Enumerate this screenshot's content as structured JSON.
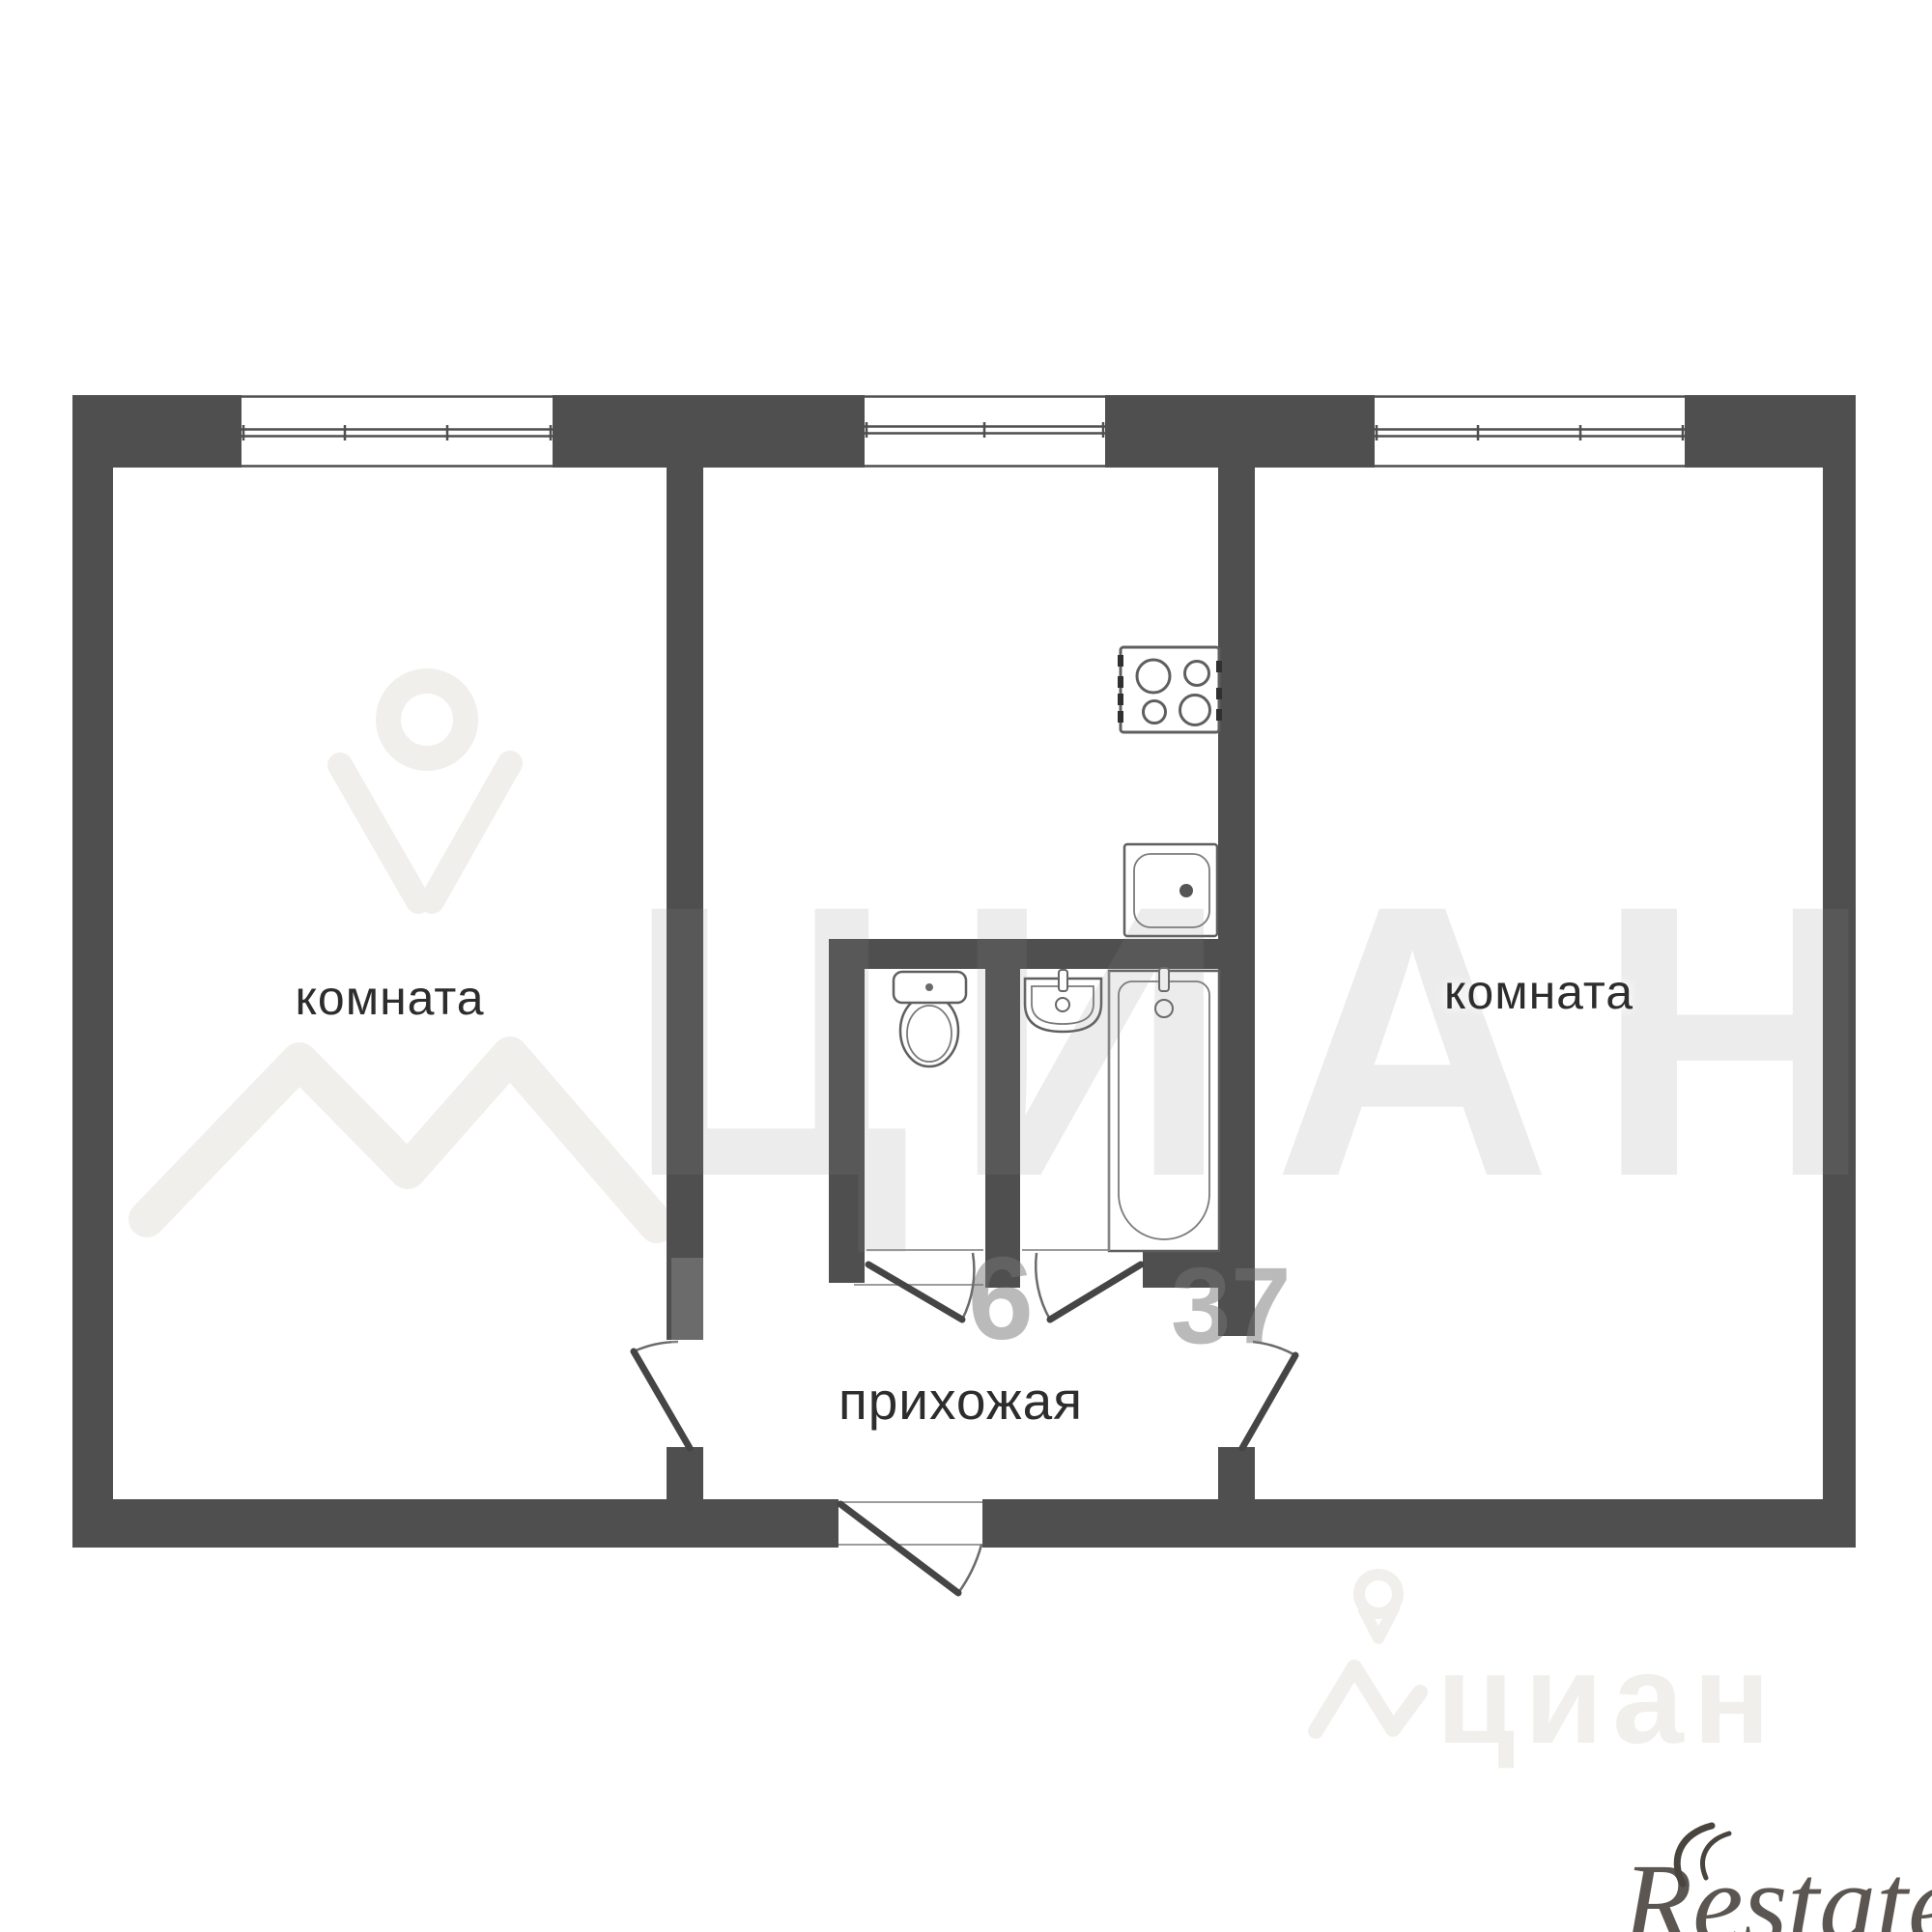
{
  "colors": {
    "background": "#ffffff",
    "wall": "#4f4f4f",
    "fixture_line": "#5f5f5f",
    "door_line": "#454545",
    "thin_line": "#9c9c9c",
    "label_text": "#2d2d2d",
    "watermark_gray": "#878787",
    "watermark_light": "#f1efec",
    "restate_color": "#4a443f"
  },
  "labels": {
    "room_left": "комната",
    "room_right": "комната",
    "hallway": "прихожая"
  },
  "watermarks": {
    "brand_large": "ЦИАН",
    "digits_left": "6",
    "digits_right": "37",
    "brand_small": "циан",
    "agency": "Restate"
  },
  "fixtures": {
    "stove": "stove-4-burner-icon",
    "kitchen_sink": "kitchen-sink-icon",
    "toilet": "toilet-icon",
    "washbasin": "washbasin-icon",
    "bathtub": "bathtub-icon"
  },
  "windows_count": "3",
  "doors_count": "5"
}
